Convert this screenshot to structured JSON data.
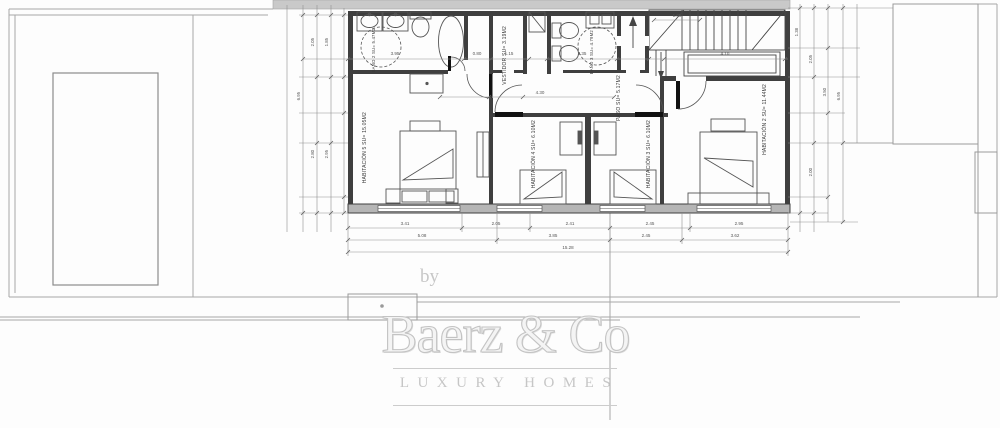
{
  "watermark": {
    "prefix": "by",
    "brand": "Baerz & Co",
    "tagline": "LUXURY HOMES"
  },
  "rooms": [
    {
      "name": "BAÑO 2",
      "area": "SU= 5.47M2"
    },
    {
      "name": "HABITACIÓN 5",
      "area": "SU= 15.05M2"
    },
    {
      "name": "VESTIDOR",
      "area": "SU= 3.19M2"
    },
    {
      "name": "BAÑO 3",
      "area": "SU= 4.79M2"
    },
    {
      "name": "PASO",
      "area": "SU= 5.17M2"
    },
    {
      "name": "HABITACIÓN 4",
      "area": "SU= 6.10M2"
    },
    {
      "name": "HABITACIÓN 3",
      "area": "SU= 6.10M2"
    },
    {
      "name": "HABITACIÓN 2",
      "area": "SU= 11.44M2"
    }
  ],
  "dimensions": {
    "bottom_row1": [
      "3.41",
      "2.05",
      "2.41",
      "2.45",
      "2.95"
    ],
    "bottom_row2": [
      "5.08",
      "3.85",
      "2.45",
      "3.62"
    ],
    "bottom_total": "15.28",
    "top_row": [
      "3.95",
      "0.80",
      "1.15",
      "2.35",
      "4.10"
    ],
    "corridor": "4.30",
    "stair": "1.05",
    "left_col": [
      "6.95",
      "2.05",
      "1.85",
      "2.80",
      "2.95"
    ],
    "right_col": [
      "6.95",
      "1.38",
      "2.05",
      "3.50",
      "2.00"
    ]
  },
  "colors": {
    "wall": "#3f3f3f",
    "wall_fill": "#b5b5b5",
    "roof_band": "#c9c9c9",
    "site_line": "#a8a8a8",
    "fixture_line": "#555555",
    "watermark": "#c6c6c6"
  }
}
